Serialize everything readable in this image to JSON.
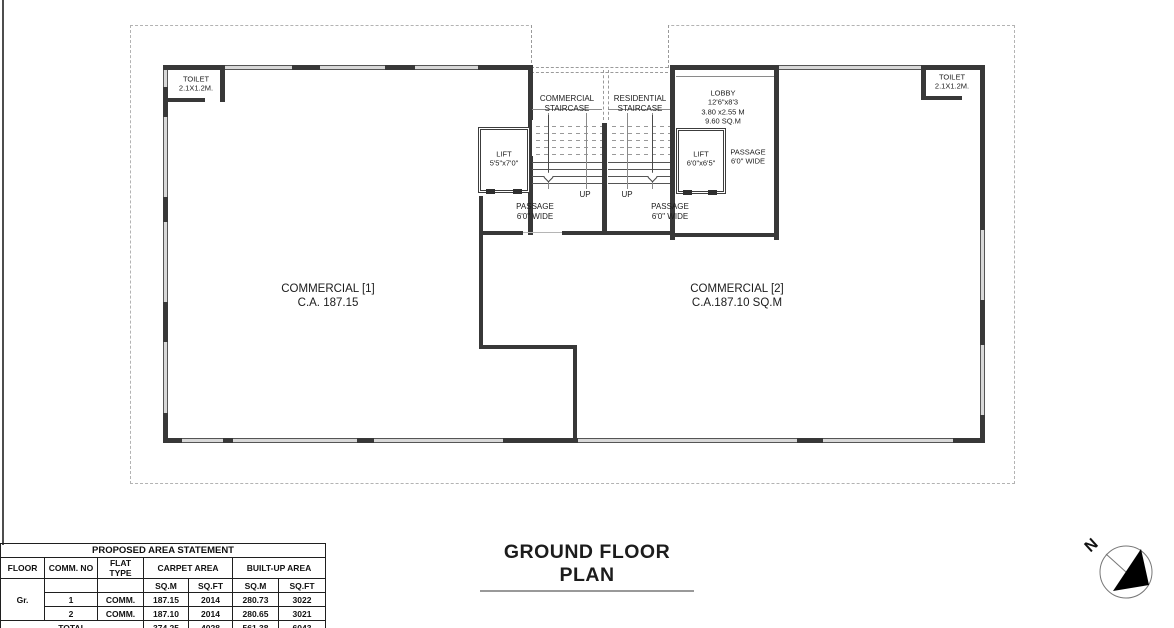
{
  "plan": {
    "toilet_left": {
      "line1": "TOILET",
      "line2": "2.1X1.2M."
    },
    "toilet_right": {
      "line1": "TOILET",
      "line2": "2.1X1.2M."
    },
    "commercial_staircase": {
      "line1": "COMMERCIAL",
      "line2": "STAIRCASE"
    },
    "residential_staircase": {
      "line1": "RESIDENTIAL",
      "line2": "STAIRCASE"
    },
    "lobby": {
      "line1": "LOBBY",
      "line2": "12'6\"x8'3",
      "line3": "3.80 x2.55 M",
      "line4": "9.60 SQ.M"
    },
    "lift_left": {
      "line1": "LIFT",
      "line2": "5'5\"x7'0\""
    },
    "lift_right": {
      "line1": "LIFT",
      "line2": "6'0\"x6'5\""
    },
    "passage_lobby": {
      "line1": "PASSAGE",
      "line2": "6'0\" WIDE"
    },
    "passage_left": {
      "line1": "PASSAGE",
      "line2": "6'0\" WIDE"
    },
    "passage_right": {
      "line1": "PASSAGE",
      "line2": "6'0\" WIDE"
    },
    "up_left": "UP",
    "up_right": "UP",
    "commercial_1": {
      "line1": "COMMERCIAL [1]",
      "line2": "C.A. 187.15"
    },
    "commercial_2": {
      "line1": "COMMERCIAL [2]",
      "line2": "C.A.187.10 SQ.M"
    }
  },
  "drawing_title": "GROUND FLOOR PLAN",
  "north_label": "N",
  "area_table": {
    "title": "PROPOSED AREA STATEMENT",
    "headers": {
      "floor": "FLOOR",
      "comm_no": "COMM. NO",
      "flat_type": "FLAT TYPE",
      "carpet": "CARPET AREA",
      "builtup": "BUILT-UP AREA",
      "sqm": "SQ.M",
      "sqft": "SQ.FT"
    },
    "floor_value": "Gr.",
    "rows": [
      {
        "comm_no": "1",
        "flat_type": "COMM.",
        "carpet_sqm": "187.15",
        "carpet_sqft": "2014",
        "builtup_sqm": "280.73",
        "builtup_sqft": "3022"
      },
      {
        "comm_no": "2",
        "flat_type": "COMM.",
        "carpet_sqm": "187.10",
        "carpet_sqft": "2014",
        "builtup_sqm": "280.65",
        "builtup_sqft": "3021"
      }
    ],
    "total_label": "TOTAL",
    "totals": {
      "carpet_sqm": "374.25",
      "carpet_sqft": "4028",
      "builtup_sqm": "561.38",
      "builtup_sqft": "6043"
    }
  },
  "colors": {
    "wall_dark": "#383838",
    "wall_light": "#d8d8d8",
    "boundary": "#b3b3b3",
    "ink": "#1c1c1c"
  }
}
